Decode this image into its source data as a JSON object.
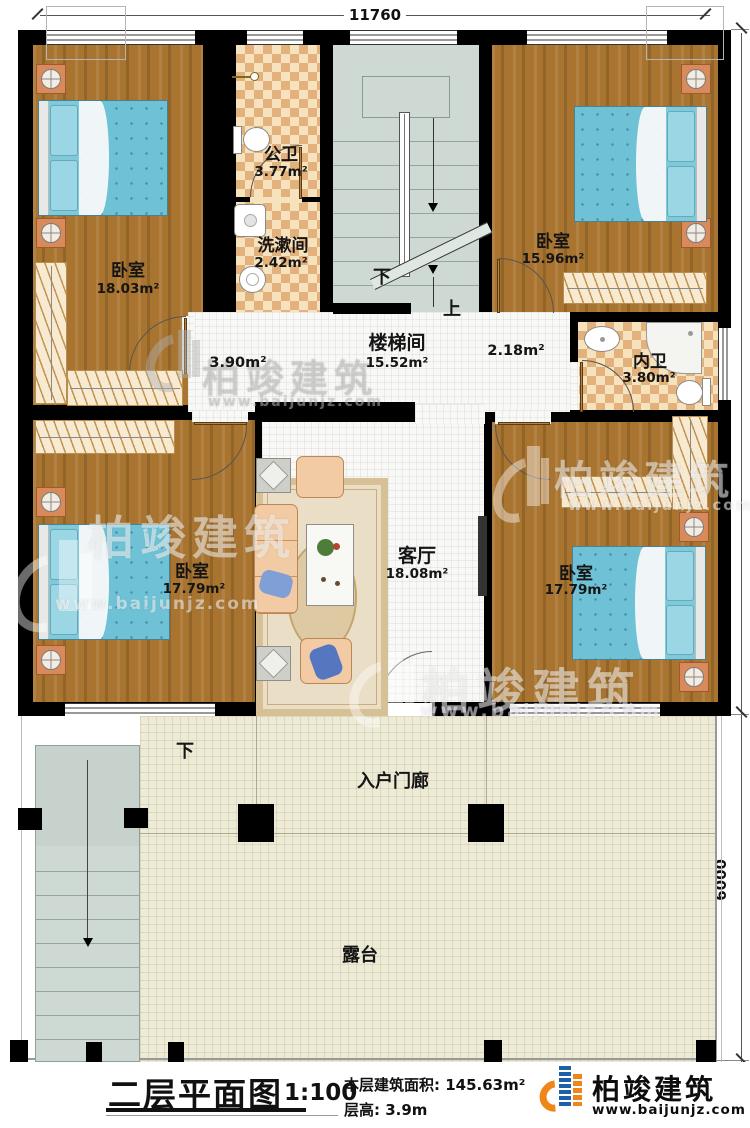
{
  "plan": {
    "dimensions": {
      "top": "11760",
      "right_upper": "11500",
      "right_lower": "6000"
    },
    "rooms": {
      "bedroom_tl": {
        "name": "卧室",
        "area": "18.03m²"
      },
      "public_bath": {
        "name": "公卫",
        "area": "3.77m²"
      },
      "washroom": {
        "name": "洗漱间",
        "area": "2.42m²"
      },
      "stair_hall": {
        "name": "楼梯间",
        "area": "15.52m²"
      },
      "bedroom_tr": {
        "name": "卧室",
        "area": "15.96m²"
      },
      "inner_bath": {
        "name": "内卫",
        "area": "3.80m²"
      },
      "hall_left_area": "3.90m²",
      "hall_right_area": "2.18m²",
      "living": {
        "name": "客厅",
        "area": "18.08m²"
      },
      "bedroom_bl": {
        "name": "卧室",
        "area": "17.79m²"
      },
      "bedroom_br": {
        "name": "卧室",
        "area": "17.79m²"
      },
      "porch": {
        "name": "入户门廊"
      },
      "terrace": {
        "name": "露台"
      }
    },
    "stair_labels": {
      "down_indoor": "下",
      "up_indoor": "上",
      "down_outdoor": "下"
    }
  },
  "footer": {
    "title": "二层平面图",
    "scale": "1:100",
    "area_label": "本层建筑面积:",
    "area_value": "145.63m²",
    "floor_height_label": "层高:",
    "floor_height_value": "3.9m"
  },
  "brand": {
    "name": "柏竣建筑",
    "url": "www.baijunjz.com"
  },
  "watermark": {
    "name": "柏竣建筑",
    "url": "www.baijunjz.com"
  },
  "colors": {
    "wall": "#000000",
    "wood_floor": "#a9742f",
    "tile_light": "#f6e3bd",
    "tile_dark": "#e2b17c",
    "stair_floor": "#cfd9d3",
    "terrace_floor": "#edead5",
    "bed_blue": "#72c4d8",
    "brand_orange": "#f08619",
    "brand_blue": "#1d62a8"
  }
}
